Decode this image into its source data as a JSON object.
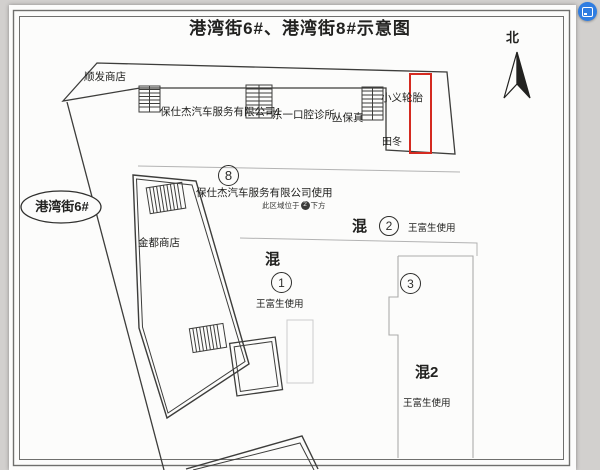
{
  "title": "港湾街6#、港湾街8#示意图",
  "north": {
    "label": "北"
  },
  "street": {
    "label": "港湾街6#"
  },
  "buildings": {
    "shunfa": "顺发商店",
    "baoshijie1": "保仕杰汽车服务有限公司1",
    "dental": "东一口腔诊所",
    "cong": "丛保真",
    "tires": "小义轮胎",
    "tiandong": "田冬",
    "jindu": "金都商店"
  },
  "central": {
    "num": "8",
    "usage": "保仕杰汽车服务有限公司使用",
    "note_pre": "此区域位于",
    "note_num": "2",
    "note_post": "下方"
  },
  "zones": {
    "z2": {
      "name": "混",
      "num": "2",
      "user": "王富生使用"
    },
    "z1": {
      "name": "混",
      "num": "1",
      "user": "王富生使用"
    },
    "z3": {
      "num": "3"
    },
    "z4": {
      "name": "混2",
      "user": "王富生使用"
    }
  },
  "colors": {
    "highlight": "#d42a20",
    "badge": "#2f7de1",
    "ink": "#3d3d3d",
    "faint": "#b3b3b3"
  }
}
